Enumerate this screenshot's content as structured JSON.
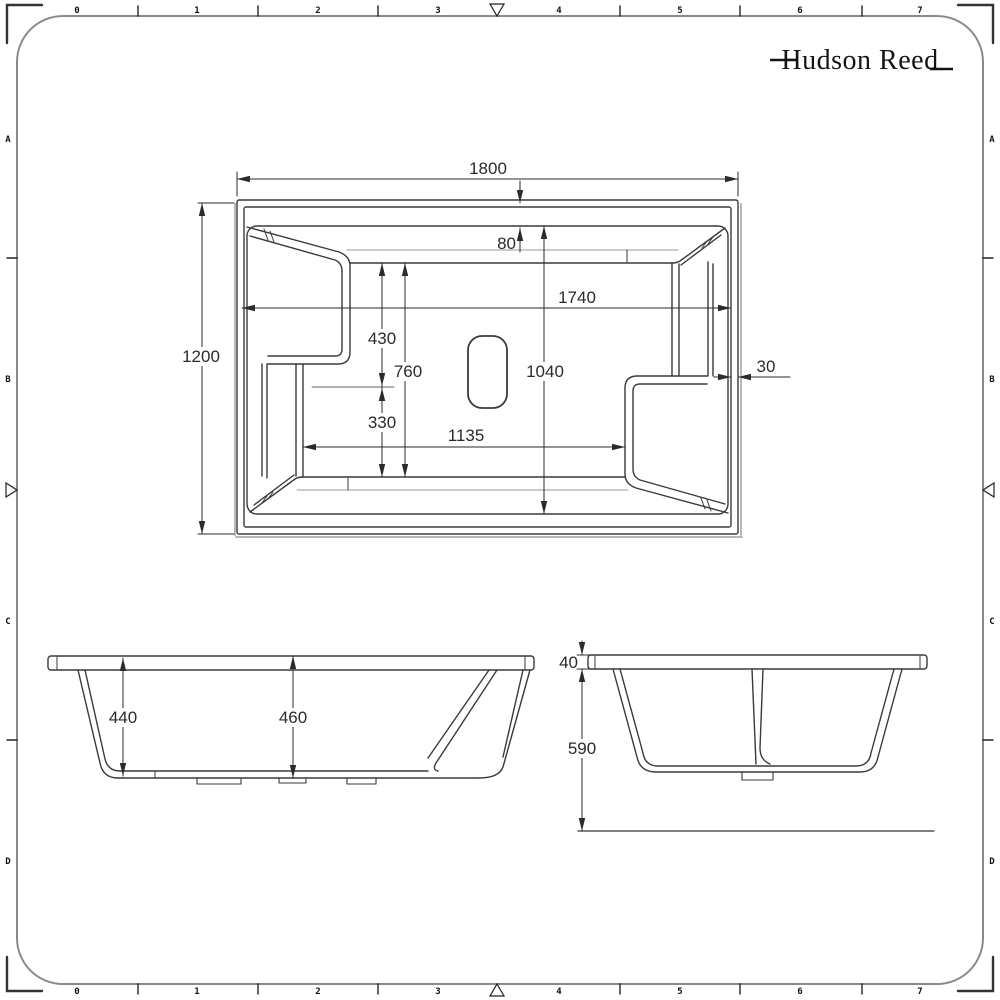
{
  "brand": {
    "name": "Hudson Reed"
  },
  "ruler": {
    "top": [
      "0",
      "1",
      "2",
      "3",
      "4",
      "5",
      "6",
      "7"
    ],
    "bottom": [
      "0",
      "1",
      "2",
      "3",
      "4",
      "5",
      "6",
      "7"
    ],
    "left": [
      "A",
      "B",
      "C",
      "D"
    ],
    "right": [
      "A",
      "B",
      "C",
      "D"
    ]
  },
  "views": {
    "plan": {
      "label": "plan-view"
    },
    "front": {
      "label": "front-elevation"
    },
    "end": {
      "label": "end-elevation"
    }
  },
  "dims": {
    "plan": {
      "overall_length": "1800",
      "overall_width": "1200",
      "rim_inset_top": "80",
      "internal_length": "1740",
      "seat_depth": "430",
      "seat_to_floor": "330",
      "floor_depth": "760",
      "floor_length": "1135",
      "internal_width": "1040",
      "wall_thickness": "30"
    },
    "front": {
      "end_depth": "440",
      "centre_depth": "460"
    },
    "end": {
      "rim_thickness": "40",
      "overall_height": "590"
    }
  },
  "colors": {
    "line": "#3a3a3a",
    "dimension": "#2b2b2b",
    "frame": "#8a8a8a",
    "shadow": "#b8b8b8"
  }
}
